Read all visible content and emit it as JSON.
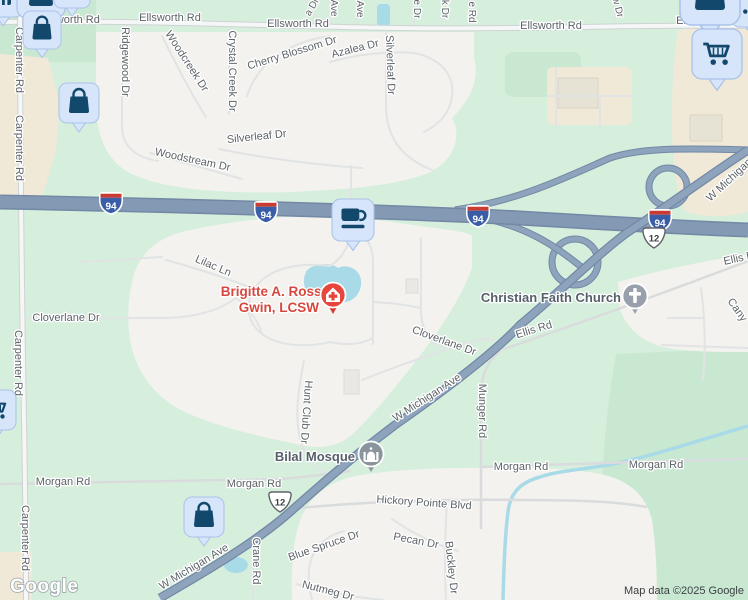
{
  "branding": {
    "logo": "Google",
    "attribution": "Map data ©2025 Google"
  },
  "shields": {
    "i94": "94",
    "us12": "12"
  },
  "pois": {
    "brigitte_line1": "Brigitte A. Ross-",
    "brigitte_line2": "Gwin, LCSW",
    "church": "Christian Faith Church",
    "mosque": "Bilal Mosque"
  },
  "roads": {
    "ellsworth": "Ellsworth Rd",
    "carpenter": "Carpenter Rd",
    "ridgewood": "Ridgewood Dr",
    "woodcreek": "Woodcreek Dr",
    "crystal_creek": "Crystal Creek Dr",
    "cherry_blossom": "Cherry Blossom Dr",
    "azalea": "Azalea Dr",
    "silverleaf": "Silverleaf Dr",
    "woodstream": "Woodstream Dr",
    "lilac": "Lilac Ln",
    "cloverlane": "Cloverlane Dr",
    "w_michigan": "W Michigan Ave",
    "ellis": "Ellis Rd",
    "canyon_partial": "Cany",
    "munger": "Munger Rd",
    "hunt_club": "Hunt Club Dr",
    "morgan": "Morgan Rd",
    "hickory": "Hickory Pointe Blvd",
    "pecan": "Pecan Dr",
    "blue_spruce": "Blue Spruce Dr",
    "nutmeg": "Nutmeg Dr",
    "buckley": "Buckley Dr",
    "crane": "Crane Rd",
    "stub_a_dr": "a Dr",
    "stub_ave": "Ave",
    "stub_e_dr": "e Dr",
    "stub_k_dr": "k Dr",
    "stub_e_rd": "e Rd",
    "stub_w_dr": "w Dr"
  },
  "icons": {
    "pin_icons": [
      "shopping-bag",
      "shopping-cart",
      "coffee-cup",
      "storefront",
      "drink-bottle"
    ],
    "poi_icons": [
      "medical-office",
      "christian-church",
      "mosque"
    ]
  },
  "colors": {
    "green_base": "#d6efdd",
    "green_dark": "#c9e8d2",
    "residential": "#f3f2ee",
    "beige": "#f0e9d8",
    "freeway": "#8399b4",
    "highway": "#8ea3bc",
    "water": "#a9dae8",
    "label_gray": "#5d6368",
    "poi_red_text": "#d6473f",
    "pin_bg": "#d7e5fb",
    "pin_glyph": "#11486b",
    "medical_pin": "#e8453c",
    "gray_pin": "#98a1ab"
  }
}
